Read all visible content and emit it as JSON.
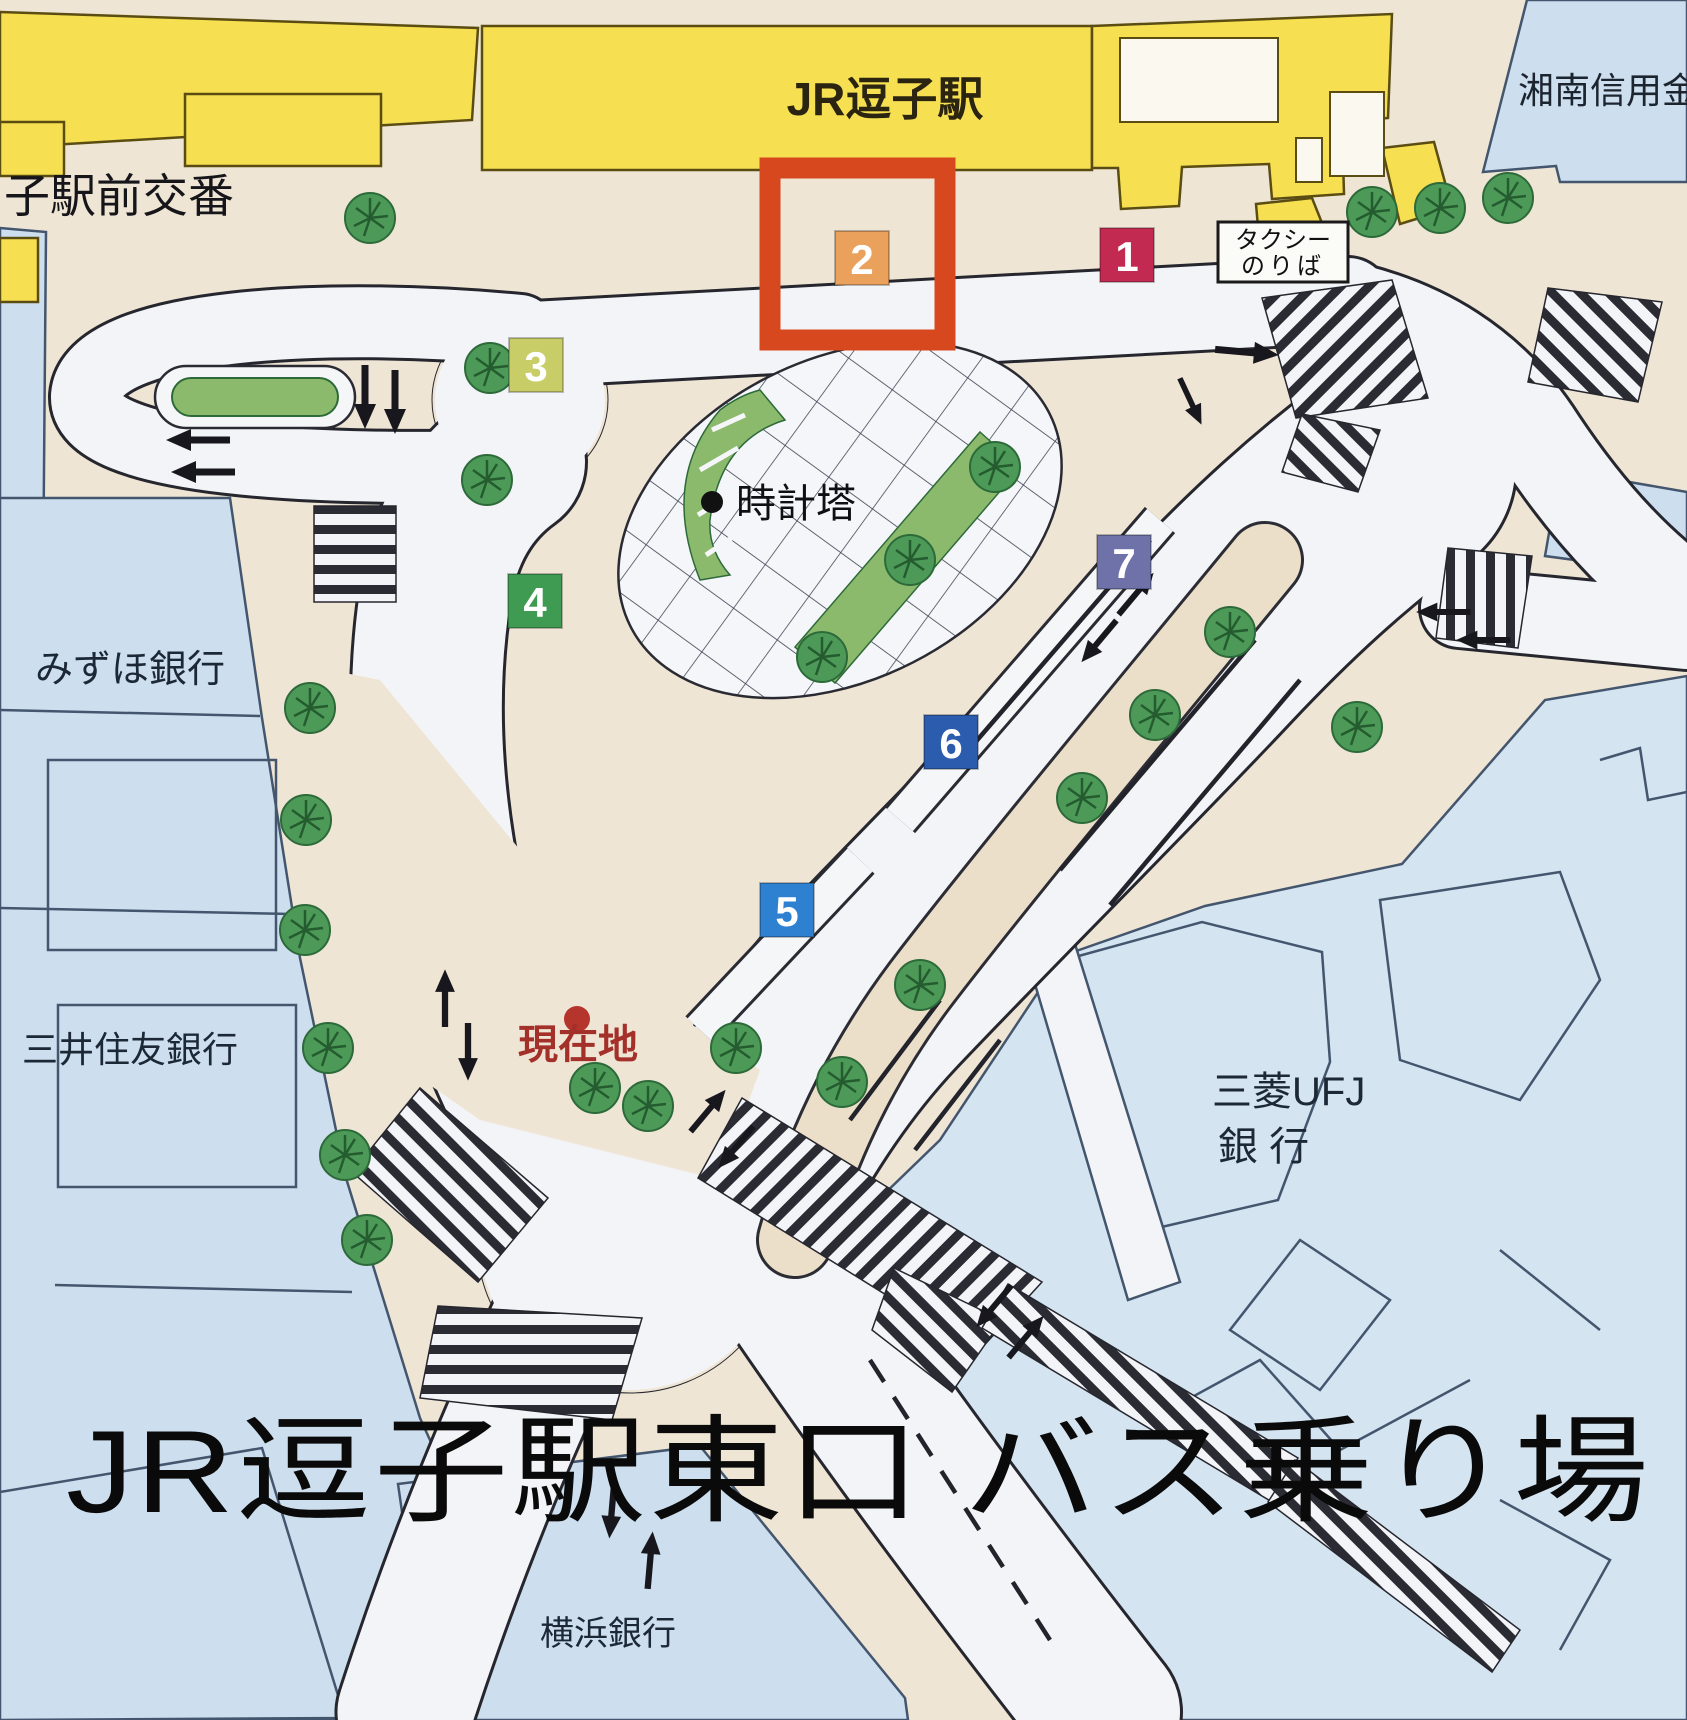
{
  "title": "JR逗子駅東口 バス乗り場",
  "map": {
    "station_label": "JR逗子駅",
    "shinkin_label": "湘南信用金",
    "police_box_label": "子駅前交番",
    "taxi_stand": {
      "line1": "タクシー",
      "line2": "のりば"
    },
    "clock_tower_label": "時計塔",
    "current_location_label": "現在地",
    "banks": {
      "mizuho": "みずほ銀行",
      "smbc": "三井住友銀行",
      "mufg_line1": "三菱UFJ",
      "mufg_line2": "銀  行",
      "yokohama": "横浜銀行"
    },
    "bus_stops": [
      {
        "number": "1",
        "color": "#c22a52"
      },
      {
        "number": "2",
        "color": "#e9a15b",
        "highlighted": true
      },
      {
        "number": "3",
        "color": "#c8cd68"
      },
      {
        "number": "4",
        "color": "#3f9b51"
      },
      {
        "number": "5",
        "color": "#2e81d0"
      },
      {
        "number": "6",
        "color": "#2b5cad"
      },
      {
        "number": "7",
        "color": "#6e72a8"
      }
    ],
    "highlight_color": "#d8481f",
    "colors": {
      "station_yellow": "#f6e052",
      "block_blue": "#cddfee",
      "plaza_beige": "#efe5d5",
      "road_white": "#f3f4f7",
      "green": "#8cba6c",
      "current_location_red": "#b5342c"
    }
  }
}
